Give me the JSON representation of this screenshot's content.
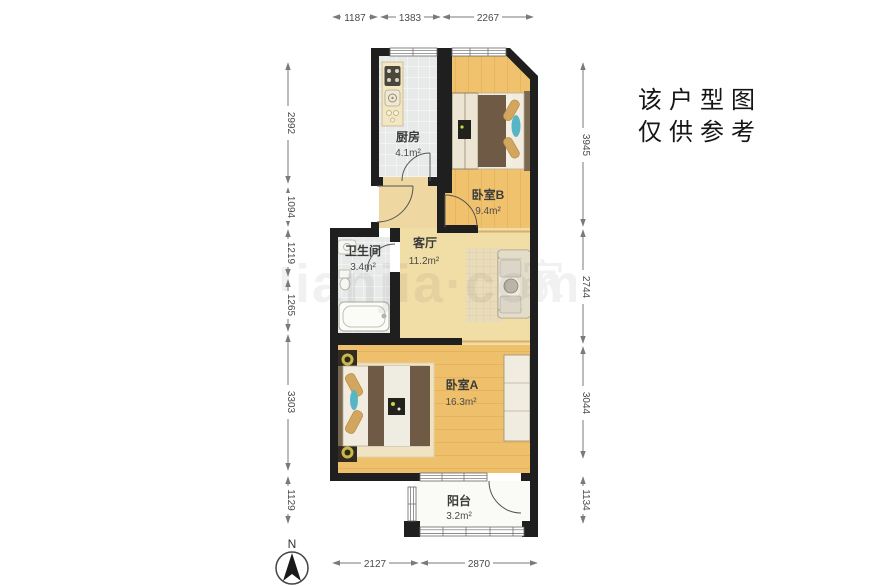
{
  "plan": {
    "rooms": [
      {
        "id": "kitchen",
        "name": "厨房",
        "area": "4.1m²"
      },
      {
        "id": "bedroomB",
        "name": "卧室B",
        "area": "9.4m²"
      },
      {
        "id": "bathroom",
        "name": "卫生间",
        "area": "3.4m²"
      },
      {
        "id": "living",
        "name": "客厅",
        "area": "11.2m²"
      },
      {
        "id": "bedroomA",
        "name": "卧室A",
        "area": "16.3m²"
      },
      {
        "id": "balcony",
        "name": "阳台",
        "area": "3.2m²"
      }
    ],
    "dimensions_mm": {
      "top": [
        "1187",
        "1383",
        "2267"
      ],
      "bottom": [
        "2127",
        "2870"
      ],
      "left": [
        "2992",
        "1094",
        "1219",
        "1265",
        "3303",
        "1129"
      ],
      "right": [
        "3945",
        "2744",
        "3044",
        "1134"
      ]
    },
    "note": {
      "line1": "该户型图",
      "line2": "仅供参考"
    },
    "compass": {
      "label": "N"
    },
    "watermark": {
      "text": "lianjia·com",
      "char": "家"
    },
    "colors": {
      "wall": "#1f1f1f",
      "wood": "#f0c26e",
      "tile": "#e8eae9",
      "accent_teal": "#57b6c6"
    }
  }
}
